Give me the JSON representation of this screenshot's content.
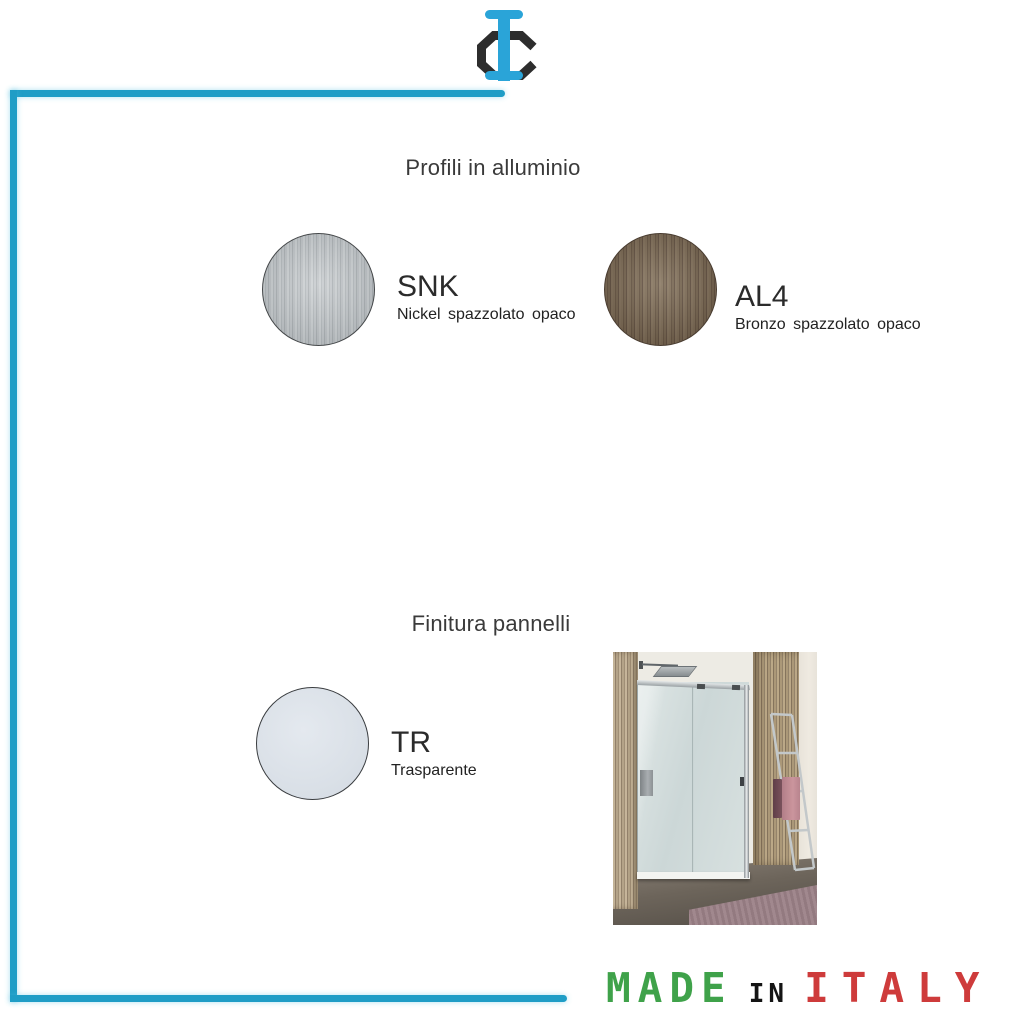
{
  "logo": {
    "name": "IC brand mark",
    "colors": {
      "c_black": "#2d2d2d",
      "i_blue": "#2aa4d8"
    }
  },
  "frame": {
    "color": "#1f9dc6"
  },
  "profili": {
    "title": "Profili in alluminio",
    "swatches": [
      {
        "code": "SNK",
        "name": "Nickel  spazzolato opaco",
        "finish_color": "#c3c8cb"
      },
      {
        "code": "AL4",
        "name": "Bronzo spazzolato opaco",
        "finish_color": "#7a6957"
      }
    ]
  },
  "finiture": {
    "title": "Finitura pannelli",
    "swatches": [
      {
        "code": "TR",
        "name": "Trasparente",
        "finish_color": "#dbe1e8"
      }
    ]
  },
  "footer": {
    "made": "MADE",
    "in": "in",
    "italy": "ITALY",
    "colors": {
      "made": "#3fa24a",
      "in": "#141414",
      "italy": "#ce3b3b"
    }
  }
}
